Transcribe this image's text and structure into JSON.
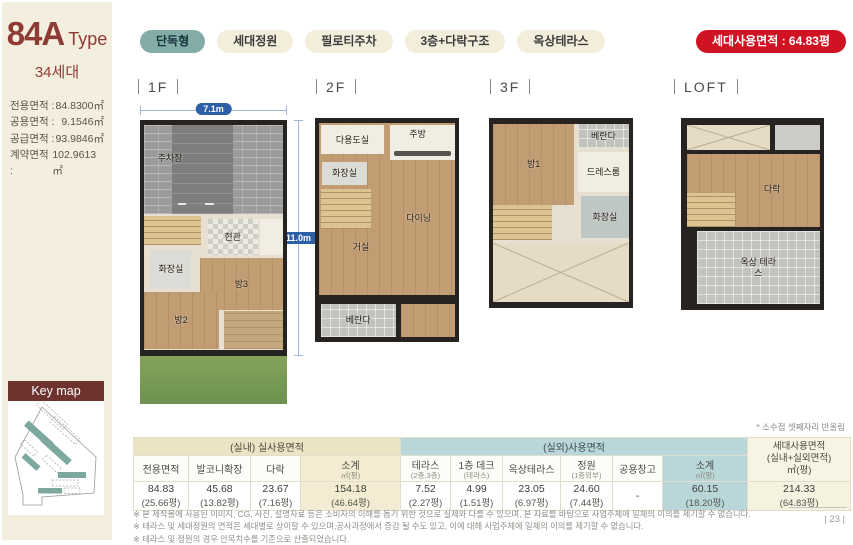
{
  "colors": {
    "accent_teal": "#84aca6",
    "accent_red": "#cf1322",
    "keymap_maroon": "#6e332e",
    "dim_blue": "#2d5fa8",
    "sidebar_cream": "#f4eede"
  },
  "header": {
    "type_title": "84A",
    "type_suffix": "Type",
    "units": "34세대",
    "areas": [
      {
        "label": "전용면적 :",
        "value": "84.8300㎡"
      },
      {
        "label": "공용면적 :",
        "value": "9.1546㎡"
      },
      {
        "label": "공급면적 :",
        "value": "93.9846㎡"
      },
      {
        "label": "계약면적 :",
        "value": "102.9613㎡"
      }
    ]
  },
  "badges": {
    "items": [
      "단독형",
      "세대정원",
      "필로티주차",
      "3층+다락구조",
      "옥상테라스"
    ],
    "highlight": "세대사용면적 : 64.83평"
  },
  "floors": [
    {
      "label": "1F",
      "dim_w": "7.1m",
      "dim_h": "11.0m",
      "rooms": [
        "주차장",
        "현관",
        "화장실",
        "방3",
        "방2"
      ]
    },
    {
      "label": "2F",
      "rooms": [
        "다용도실",
        "주방",
        "화장실",
        "다이닝",
        "거실",
        "베란다"
      ]
    },
    {
      "label": "3F",
      "rooms": [
        "방1",
        "베란다",
        "드레스룸",
        "화장실"
      ]
    },
    {
      "label": "LOFT",
      "rooms": [
        "다락",
        "옥상 테라스"
      ]
    }
  ],
  "keymap": {
    "title": "Key map"
  },
  "table": {
    "note": "* 소수점 셋째자리 반올림",
    "group_indoor": "(실내) 실사용면적",
    "group_outdoor": "(실외)사용면적",
    "total": {
      "l1": "세대사용면적",
      "l2": "(실내+실외면적)",
      "l3": "㎡(평)"
    },
    "columns": [
      {
        "label": "전용면적",
        "sub": ""
      },
      {
        "label": "발코니확장",
        "sub": ""
      },
      {
        "label": "다락",
        "sub": ""
      },
      {
        "label": "소계",
        "sub": "㎡(평)"
      },
      {
        "label": "테라스",
        "sub": "(2층,3층)"
      },
      {
        "label": "1층 데크",
        "sub": "(테라스)"
      },
      {
        "label": "옥상테라스",
        "sub": ""
      },
      {
        "label": "정원",
        "sub": "(1층외부)"
      },
      {
        "label": "공용창고",
        "sub": ""
      },
      {
        "label": "소계",
        "sub": "㎡(평)"
      }
    ],
    "values": [
      {
        "m2": "84.83",
        "py": "(25.66평)"
      },
      {
        "m2": "45.68",
        "py": "(13.82평)"
      },
      {
        "m2": "23.67",
        "py": "(7.16평)"
      },
      {
        "m2": "154.18",
        "py": "(46.64평)"
      },
      {
        "m2": "7.52",
        "py": "(2.27평)"
      },
      {
        "m2": "4.99",
        "py": "(1.51평)"
      },
      {
        "m2": "23.05",
        "py": "(6.97평)"
      },
      {
        "m2": "24.60",
        "py": "(7.44평)"
      },
      {
        "m2": "-",
        "py": ""
      },
      {
        "m2": "60.15",
        "py": "(18.20평)"
      },
      {
        "m2": "214.33",
        "py": "(64.83평)"
      }
    ]
  },
  "footnotes": [
    "※ 본 제작물에 사용된 이미지, CG, 사진, 설명자료 등은 소비자의 이해를 돕기 위한 것으로 실제와 다를 수 있으며, 본 자료를 바탕으로 사업주체에 일체의 이의를 제기할 수 없습니다.",
    "※ 테라스 및 세대정원의 면적은 세대별로 상이할 수 있으며,공사과정에서 증감 될 수도 있고, 이에 대해 사업주체에 일체의 이의를 제기할 수 없습니다.",
    "※ 테라스 및 정원의 경우 안목치수를 기준으로 산출되었습니다."
  ],
  "page_number": "| 23 |"
}
